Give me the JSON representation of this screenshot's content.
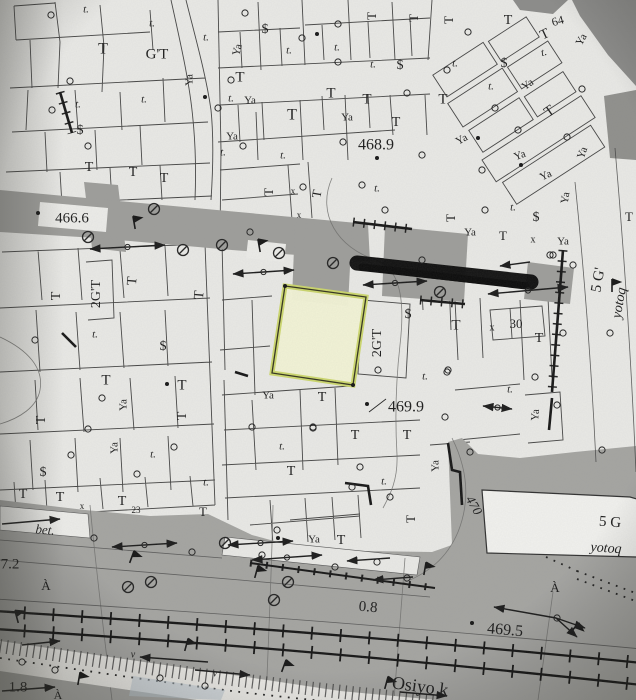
{
  "map": {
    "kind": "scanned cadastral plan",
    "colors": {
      "paper": "#e8e8e5",
      "road": "#a0a09d",
      "road_dark": "#8b8b89",
      "ink": "#2e2e2e",
      "highlight_fill": "#f3f4d6",
      "highlight_edge": "#ccd76a",
      "redaction": "#0b0b0b",
      "water_tint": "#b9c6cf"
    },
    "labels": [
      {
        "t": "t.",
        "x": 86,
        "y": 10,
        "i": 1
      },
      {
        "t": "t.",
        "x": 152,
        "y": 24,
        "i": 1
      },
      {
        "t": "T",
        "x": 103,
        "y": 50,
        "s": 16
      },
      {
        "t": "G'T",
        "x": 157,
        "y": 55,
        "s": 15
      },
      {
        "t": "t.",
        "x": 206,
        "y": 38,
        "i": 1
      },
      {
        "t": "Ya",
        "x": 190,
        "y": 80,
        "r": -90
      },
      {
        "t": "t.",
        "x": 78,
        "y": 105,
        "i": 1
      },
      {
        "t": "t.",
        "x": 144,
        "y": 100,
        "i": 1
      },
      {
        "t": "$",
        "x": 80,
        "y": 131,
        "s": 14
      },
      {
        "t": "t.",
        "x": 231,
        "y": 99,
        "i": 1
      },
      {
        "t": "$",
        "x": 265,
        "y": 30,
        "s": 14
      },
      {
        "t": "Ya",
        "x": 238,
        "y": 50,
        "r": -75
      },
      {
        "t": "t.",
        "x": 289,
        "y": 51,
        "i": 1
      },
      {
        "t": "t.",
        "x": 337,
        "y": 48,
        "i": 1
      },
      {
        "t": "t.",
        "x": 373,
        "y": 65,
        "i": 1
      },
      {
        "t": "$",
        "x": 400,
        "y": 66,
        "s": 14
      },
      {
        "t": "T",
        "x": 240,
        "y": 78,
        "s": 15
      },
      {
        "t": "Ya",
        "x": 250,
        "y": 101
      },
      {
        "t": "T",
        "x": 292,
        "y": 116,
        "s": 16
      },
      {
        "t": "T",
        "x": 331,
        "y": 94,
        "s": 15
      },
      {
        "t": "T",
        "x": 367,
        "y": 100,
        "s": 15
      },
      {
        "t": "Ya",
        "x": 347,
        "y": 118
      },
      {
        "t": "T",
        "x": 396,
        "y": 123,
        "s": 14
      },
      {
        "t": "Ya",
        "x": 232,
        "y": 137
      },
      {
        "t": "t.",
        "x": 223,
        "y": 153,
        "i": 1
      },
      {
        "t": "t.",
        "x": 283,
        "y": 156,
        "i": 1
      },
      {
        "t": "468.9",
        "x": 376,
        "y": 146,
        "s": 16
      },
      {
        "t": "T",
        "x": 373,
        "y": 16,
        "r": -90,
        "s": 13
      },
      {
        "t": "T",
        "x": 415,
        "y": 18,
        "r": -90,
        "s": 13
      },
      {
        "t": "T",
        "x": 450,
        "y": 20,
        "r": -90,
        "s": 13
      },
      {
        "t": "T",
        "x": 508,
        "y": 21,
        "s": 14
      },
      {
        "t": "64",
        "x": 558,
        "y": 22,
        "s": 12,
        "r": -15
      },
      {
        "t": "T",
        "x": 545,
        "y": 35,
        "r": -25,
        "s": 14
      },
      {
        "t": "t.",
        "x": 455,
        "y": 64,
        "i": 1
      },
      {
        "t": "$",
        "x": 504,
        "y": 64,
        "s": 14
      },
      {
        "t": "t.",
        "x": 544,
        "y": 53,
        "i": 1,
        "r": -15
      },
      {
        "t": "Ya",
        "x": 582,
        "y": 40,
        "r": -60
      },
      {
        "t": "t.",
        "x": 491,
        "y": 87,
        "i": 1
      },
      {
        "t": "Ya",
        "x": 528,
        "y": 85,
        "r": -35
      },
      {
        "t": "T",
        "x": 443,
        "y": 100,
        "s": 15
      },
      {
        "t": "T",
        "x": 550,
        "y": 112,
        "r": -35,
        "s": 15
      },
      {
        "t": "Ya",
        "x": 462,
        "y": 140,
        "r": -30
      },
      {
        "t": "Ya",
        "x": 520,
        "y": 156,
        "r": -20
      },
      {
        "t": "Ya",
        "x": 546,
        "y": 176,
        "r": -25
      },
      {
        "t": "Ya",
        "x": 583,
        "y": 153,
        "r": -70
      },
      {
        "t": "t.",
        "x": 513,
        "y": 208,
        "i": 1
      },
      {
        "t": "$",
        "x": 536,
        "y": 218,
        "s": 14
      },
      {
        "t": "Ya",
        "x": 566,
        "y": 198,
        "r": -80
      },
      {
        "t": "T",
        "x": 452,
        "y": 218,
        "r": -90,
        "s": 13
      },
      {
        "t": "Ya",
        "x": 470,
        "y": 233
      },
      {
        "t": "T",
        "x": 503,
        "y": 237,
        "s": 13
      },
      {
        "t": "x",
        "x": 533,
        "y": 240,
        "s": 10
      },
      {
        "t": "Ya",
        "x": 563,
        "y": 242
      },
      {
        "t": "T",
        "x": 629,
        "y": 218,
        "s": 13
      },
      {
        "t": "5 G'",
        "x": 599,
        "y": 280,
        "r": -80,
        "s": 15
      },
      {
        "t": "yotoq",
        "x": 620,
        "y": 303,
        "r": -80,
        "s": 14,
        "i": 1
      },
      {
        "t": "T",
        "x": 89,
        "y": 168,
        "s": 14
      },
      {
        "t": "T",
        "x": 133,
        "y": 173,
        "s": 14
      },
      {
        "t": "T",
        "x": 164,
        "y": 179,
        "s": 14
      },
      {
        "t": "466.6",
        "x": 72,
        "y": 219,
        "s": 15
      },
      {
        "t": "2G'T",
        "x": 97,
        "y": 294,
        "r": -90,
        "s": 14
      },
      {
        "t": "T",
        "x": 57,
        "y": 296,
        "r": -90,
        "s": 14
      },
      {
        "t": "T",
        "x": 133,
        "y": 281,
        "r": -85,
        "s": 14
      },
      {
        "t": "T",
        "x": 200,
        "y": 295,
        "r": -85,
        "s": 14
      },
      {
        "t": "$",
        "x": 163,
        "y": 347,
        "s": 14
      },
      {
        "t": "t.",
        "x": 95,
        "y": 335,
        "i": 1
      },
      {
        "t": "T",
        "x": 106,
        "y": 381,
        "s": 15
      },
      {
        "t": "T",
        "x": 182,
        "y": 386,
        "s": 15
      },
      {
        "t": "T",
        "x": 42,
        "y": 420,
        "r": -90,
        "s": 14
      },
      {
        "t": "Ya",
        "x": 124,
        "y": 405,
        "r": -90
      },
      {
        "t": "Ya",
        "x": 115,
        "y": 448,
        "r": -90
      },
      {
        "t": "T",
        "x": 183,
        "y": 416,
        "r": -90,
        "s": 14
      },
      {
        "t": "t.",
        "x": 153,
        "y": 455,
        "i": 1
      },
      {
        "t": "$",
        "x": 43,
        "y": 473,
        "s": 14
      },
      {
        "t": "T",
        "x": 23,
        "y": 495,
        "s": 14
      },
      {
        "t": "T",
        "x": 60,
        "y": 498,
        "s": 14
      },
      {
        "t": "T",
        "x": 122,
        "y": 502,
        "s": 14
      },
      {
        "t": "23",
        "x": 136,
        "y": 511,
        "s": 9
      },
      {
        "t": "x",
        "x": 82,
        "y": 507,
        "s": 9
      },
      {
        "t": "t.",
        "x": 206,
        "y": 483,
        "i": 1
      },
      {
        "t": "t.",
        "x": 377,
        "y": 189,
        "i": 1
      },
      {
        "t": "T",
        "x": 270,
        "y": 192,
        "r": -90,
        "s": 13
      },
      {
        "t": "T",
        "x": 318,
        "y": 194,
        "r": -80,
        "s": 13
      },
      {
        "t": "x",
        "x": 293,
        "y": 192,
        "s": 9
      },
      {
        "t": "x",
        "x": 299,
        "y": 216,
        "s": 9
      },
      {
        "t": "2G'T",
        "x": 378,
        "y": 343,
        "r": -90,
        "s": 14
      },
      {
        "t": "$",
        "x": 408,
        "y": 315,
        "s": 14
      },
      {
        "t": "T",
        "x": 456,
        "y": 326,
        "s": 15
      },
      {
        "t": "x",
        "x": 492,
        "y": 328,
        "s": 10
      },
      {
        "t": "30",
        "x": 516,
        "y": 325,
        "s": 13
      },
      {
        "t": "T",
        "x": 539,
        "y": 339,
        "s": 14
      },
      {
        "t": "t.",
        "x": 425,
        "y": 377,
        "i": 1
      },
      {
        "t": "t.",
        "x": 510,
        "y": 390,
        "i": 1
      },
      {
        "t": "469.9",
        "x": 406,
        "y": 408,
        "s": 16
      },
      {
        "t": "T",
        "x": 322,
        "y": 398,
        "s": 14
      },
      {
        "t": "Ya",
        "x": 268,
        "y": 396
      },
      {
        "t": "T",
        "x": 355,
        "y": 436,
        "s": 14
      },
      {
        "t": "T",
        "x": 407,
        "y": 436,
        "s": 14
      },
      {
        "t": "t.",
        "x": 282,
        "y": 447,
        "i": 1
      },
      {
        "t": "T",
        "x": 291,
        "y": 472,
        "s": 14
      },
      {
        "t": "t.",
        "x": 384,
        "y": 482,
        "i": 1
      },
      {
        "t": "Ya",
        "x": 436,
        "y": 466,
        "r": -90
      },
      {
        "t": "Ya",
        "x": 536,
        "y": 415,
        "r": -85
      },
      {
        "t": "T",
        "x": 412,
        "y": 519,
        "r": -90,
        "s": 13
      },
      {
        "t": "Ya",
        "x": 314,
        "y": 540
      },
      {
        "t": "T",
        "x": 341,
        "y": 541,
        "s": 14
      },
      {
        "t": "T",
        "x": 203,
        "y": 513,
        "s": 13
      },
      {
        "t": "470",
        "x": 473,
        "y": 506,
        "r": 60,
        "s": 13,
        "i": 1
      },
      {
        "t": "5 G",
        "x": 610,
        "y": 523,
        "s": 15,
        "r": 4
      },
      {
        "t": "yotoq",
        "x": 606,
        "y": 549,
        "s": 14,
        "i": 1,
        "r": 4
      },
      {
        "t": "À",
        "x": 555,
        "y": 589,
        "s": 13
      },
      {
        "t": "469.5",
        "x": 505,
        "y": 631,
        "s": 16,
        "r": 5
      },
      {
        "t": "Osiyo k",
        "x": 420,
        "y": 688,
        "s": 18,
        "r": 8
      },
      {
        "t": "0.8",
        "x": 368,
        "y": 608,
        "s": 15,
        "r": 5
      },
      {
        "t": "7.2",
        "x": 10,
        "y": 565,
        "s": 15
      },
      {
        "t": "À",
        "x": 46,
        "y": 587,
        "s": 13
      },
      {
        "t": "1.8",
        "x": 18,
        "y": 688,
        "s": 15
      },
      {
        "t": "À",
        "x": 58,
        "y": 696,
        "s": 12
      },
      {
        "t": "bet.",
        "x": 45,
        "y": 531,
        "i": 1,
        "s": 13,
        "r": 5
      },
      {
        "t": "v",
        "x": 133,
        "y": 655,
        "s": 10,
        "i": 1
      },
      {
        "t": "v",
        "x": 215,
        "y": 674,
        "s": 10,
        "i": 1
      }
    ],
    "symbols": {
      "circles": [
        [
          51,
          15
        ],
        [
          70,
          81
        ],
        [
          52,
          110
        ],
        [
          88,
          146
        ],
        [
          231,
          80
        ],
        [
          245,
          13
        ],
        [
          302,
          38
        ],
        [
          338,
          24
        ],
        [
          338,
          62
        ],
        [
          407,
          93
        ],
        [
          218,
          108
        ],
        [
          343,
          142
        ],
        [
          243,
          146
        ],
        [
          468,
          32
        ],
        [
          447,
          70
        ],
        [
          495,
          108
        ],
        [
          518,
          130
        ],
        [
          582,
          89
        ],
        [
          567,
          137
        ],
        [
          422,
          260
        ],
        [
          250,
          232
        ],
        [
          303,
          187
        ],
        [
          362,
          185
        ],
        [
          385,
          210
        ],
        [
          422,
          155
        ],
        [
          553,
          255
        ],
        [
          573,
          265
        ],
        [
          563,
          333
        ],
        [
          610,
          333
        ],
        [
          535,
          377
        ],
        [
          448,
          370
        ],
        [
          35,
          340
        ],
        [
          102,
          398
        ],
        [
          88,
          429
        ],
        [
          71,
          455
        ],
        [
          137,
          474
        ],
        [
          174,
          447
        ],
        [
          378,
          370
        ],
        [
          447,
          372
        ],
        [
          445,
          417
        ],
        [
          313,
          428
        ],
        [
          360,
          467
        ],
        [
          390,
          497
        ],
        [
          352,
          487
        ],
        [
          470,
          452
        ],
        [
          252,
          427
        ],
        [
          313,
          427
        ],
        [
          277,
          530
        ],
        [
          94,
          538
        ],
        [
          192,
          552
        ],
        [
          262,
          555
        ],
        [
          335,
          567
        ],
        [
          377,
          562
        ],
        [
          407,
          578
        ],
        [
          22,
          662
        ],
        [
          55,
          670
        ],
        [
          160,
          678
        ],
        [
          205,
          686
        ],
        [
          557,
          618
        ],
        [
          602,
          450
        ],
        [
          557,
          405
        ],
        [
          482,
          170
        ],
        [
          485,
          210
        ],
        [
          550,
          255
        ]
      ],
      "manholes": [
        [
          88,
          237
        ],
        [
          154,
          209
        ],
        [
          183,
          250
        ],
        [
          222,
          245
        ],
        [
          279,
          253
        ],
        [
          333,
          263
        ],
        [
          440,
          292
        ],
        [
          225,
          543
        ],
        [
          288,
          582
        ],
        [
          274,
          600
        ],
        [
          128,
          587
        ],
        [
          151,
          582
        ]
      ],
      "dots": [
        [
          38,
          213
        ],
        [
          205,
          97
        ],
        [
          317,
          34
        ],
        [
          377,
          158
        ],
        [
          478,
          138
        ],
        [
          521,
          165
        ],
        [
          367,
          404
        ],
        [
          472,
          623
        ],
        [
          278,
          538
        ],
        [
          167,
          384
        ],
        [
          285,
          286
        ],
        [
          353,
          385
        ]
      ],
      "flags": [
        [
          135,
          228,
          -10
        ],
        [
          260,
          251,
          -10
        ],
        [
          612,
          291,
          0
        ],
        [
          130,
          562,
          20
        ],
        [
          255,
          577,
          15
        ],
        [
          424,
          574,
          10
        ],
        [
          18,
          622,
          -15
        ],
        [
          185,
          650,
          15
        ],
        [
          282,
          671,
          20
        ],
        [
          385,
          688,
          15
        ],
        [
          571,
          632,
          40
        ],
        [
          78,
          684,
          10
        ]
      ]
    },
    "arrows": [
      [
        90,
        249,
        165,
        245,
        1
      ],
      [
        233,
        274,
        294,
        270,
        1
      ],
      [
        363,
        285,
        427,
        281,
        1
      ],
      [
        488,
        294,
        568,
        287,
        1
      ],
      [
        530,
        262,
        500,
        266,
        0
      ],
      [
        2,
        524,
        60,
        519,
        0
      ],
      [
        112,
        547,
        177,
        543,
        1
      ],
      [
        228,
        545,
        293,
        541,
        1
      ],
      [
        252,
        560,
        322,
        555,
        1
      ],
      [
        390,
        558,
        347,
        561,
        0
      ],
      [
        413,
        577,
        373,
        580,
        0
      ],
      [
        556,
        618,
        494,
        607,
        0
      ],
      [
        556,
        618,
        585,
        628,
        0
      ],
      [
        556,
        618,
        577,
        637,
        0
      ],
      [
        22,
        645,
        60,
        641,
        0
      ],
      [
        2,
        691,
        55,
        687,
        0
      ],
      [
        208,
        662,
        140,
        657,
        0
      ],
      [
        195,
        670,
        250,
        675,
        0
      ],
      [
        400,
        692,
        447,
        696,
        0
      ],
      [
        483,
        406,
        512,
        409,
        1
      ]
    ],
    "leaders": [
      [
        369,
        412,
        386,
        399
      ]
    ]
  }
}
